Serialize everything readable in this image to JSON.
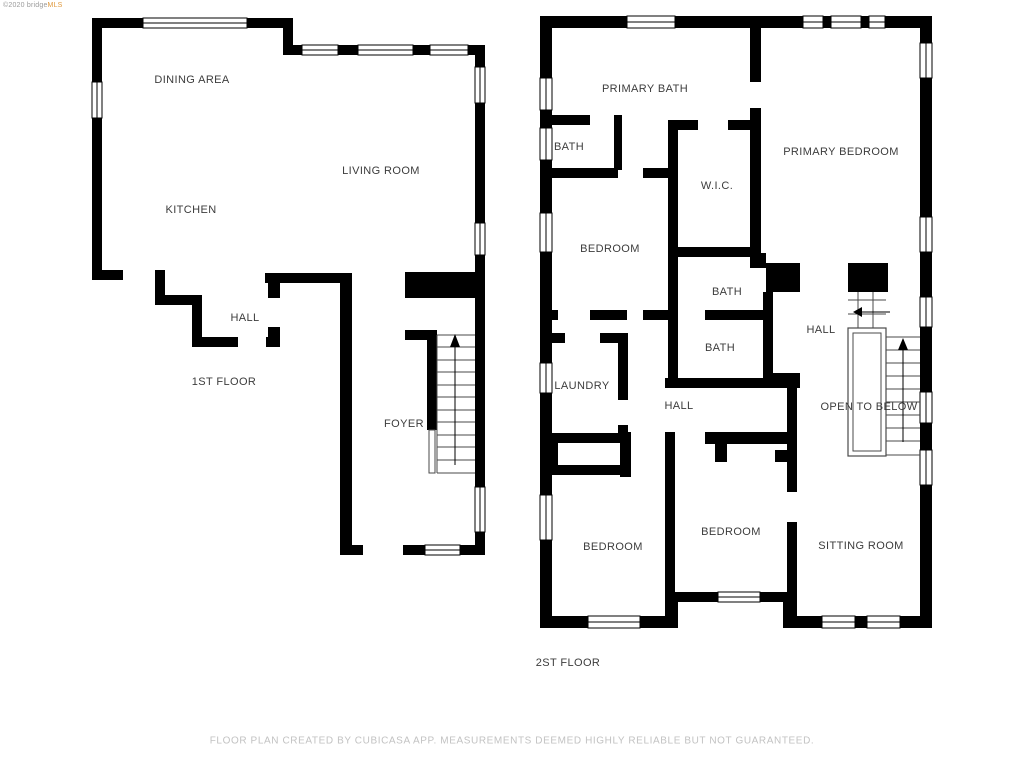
{
  "watermark": {
    "text_gray": "©2020 bridge",
    "text_accent": "MLS"
  },
  "floor1": {
    "title": "1ST FLOOR",
    "rooms": {
      "dining": "DINING AREA",
      "living": "LIVING ROOM",
      "kitchen": "KITCHEN",
      "hall": "HALL",
      "foyer": "FOYER"
    }
  },
  "floor2": {
    "title": "2ST FLOOR",
    "rooms": {
      "primary_bath": "PRIMARY BATH",
      "bath_upper": "BATH",
      "primary_bedroom": "PRIMARY BEDROOM",
      "wic": "W.I.C.",
      "bedroom_left": "BEDROOM",
      "bath_mid": "BATH",
      "bath_lower": "BATH",
      "hall_right": "HALL",
      "laundry": "LAUNDRY",
      "hall_center": "HALL",
      "open_to_below": "OPEN TO BELOW",
      "bedroom_bottom_left": "BEDROOM",
      "bedroom_bottom_center": "BEDROOM",
      "sitting_room": "SITTING ROOM"
    }
  },
  "disclaimer": "FLOOR PLAN CREATED BY CUBICASA APP. MEASUREMENTS DEEMED HIGHLY RELIABLE BUT NOT GUARANTEED.",
  "colors": {
    "background": "#ffffff",
    "walls": "#000000",
    "room_label": "#3c3c3c",
    "disclaimer": "#c2c2c2",
    "watermark_gray": "#9a9a9a",
    "watermark_accent": "#e09a3e"
  }
}
